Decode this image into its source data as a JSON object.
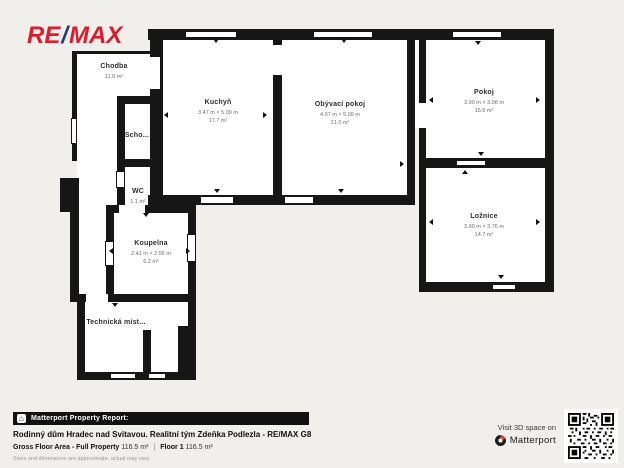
{
  "logo": {
    "re": "RE",
    "slash": "/",
    "max": "MAX"
  },
  "colors": {
    "remax_red": "#DC1C2E",
    "remax_blue": "#1F3D7C",
    "wall": "#161616",
    "background": "#F1EFEB",
    "floor": "#FFFFFF"
  },
  "icons": {
    "house": "⌂"
  },
  "floorplan": {
    "rooms": [
      {
        "id": "chodba",
        "name": "Chodba",
        "dims": "",
        "area": "11.8 m²"
      },
      {
        "id": "schodiste",
        "name": "Scho...",
        "dims": "",
        "area": ""
      },
      {
        "id": "wc",
        "name": "WC",
        "dims": "",
        "area": "1.1 m²"
      },
      {
        "id": "koupelna",
        "name": "Koupelna",
        "dims": "2.41 m × 2.56 m",
        "area": "6.2 m²"
      },
      {
        "id": "technicka-mistnost",
        "name": "Technická míst...",
        "dims": "",
        "area": ""
      },
      {
        "id": "kuchyn",
        "name": "Kuchyň",
        "dims": "3.47 m × 5.09 m",
        "area": "17.7 m²"
      },
      {
        "id": "obyvaci-pokoj",
        "name": "Obývací pokoj",
        "dims": "4.07 m × 5.09 m",
        "area": "21.0 m²"
      },
      {
        "id": "pokoj",
        "name": "Pokoj",
        "dims": "3.90 m × 3.98 m",
        "area": "15.5 m²"
      },
      {
        "id": "loznice",
        "name": "Ložnice",
        "dims": "3.90 m × 3.76 m",
        "area": "14.7 m²"
      }
    ]
  },
  "report": {
    "bar_label": "Matterport Property Report:",
    "title": "Rodinný dům Hradec nad Svitavou. Realitní tým Zdeňka Podlezla - RE/MAX G8",
    "gfa_label": "Gross Floor Area - Full Property",
    "gfa_value": "116.5 m²",
    "separator": "|",
    "floor_label": "Floor 1",
    "floor_value": "116.5 m²",
    "disclaimer": "Sizes and dimensions are approximate, actual may vary"
  },
  "visit": {
    "line1": "Visit 3D space on",
    "brand": "Matterport"
  }
}
